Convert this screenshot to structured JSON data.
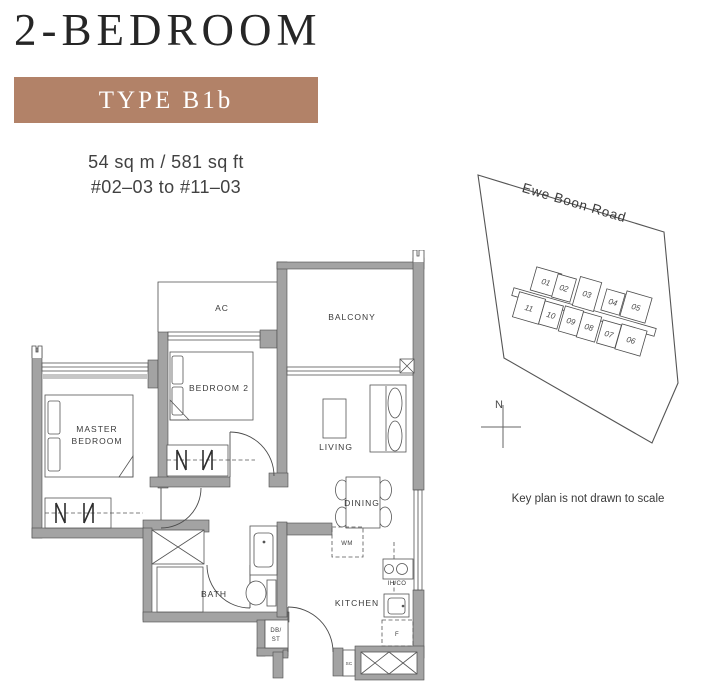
{
  "header": {
    "title": "2-BEDROOM",
    "type_label": "TYPE B1b",
    "area": "54 sq m / 581 sq ft",
    "unit_range": "#02–03 to #11–03"
  },
  "floor_plan": {
    "labels": {
      "ac": "AC",
      "balcony": "BALCONY",
      "bedroom2": "BEDROOM 2",
      "master_line1": "MASTER",
      "master_line2": "BEDROOM",
      "living": "LIVING",
      "dining": "DINING",
      "wm": "WM",
      "bath": "BATH",
      "kitchen": "KITCHEN",
      "ihco": "IH/CO",
      "fridge": "F",
      "dbst_line1": "DB/",
      "dbst_line2": "ST",
      "sc": "SC"
    }
  },
  "key_plan": {
    "road": "Ewe Boon Road",
    "note": "Key plan is not drawn to scale",
    "compass": "N",
    "highlighted_unit": "03",
    "units_top": [
      "01",
      "02",
      "03",
      "04",
      "05"
    ],
    "units_bottom": [
      "11",
      "10",
      "09",
      "08",
      "07",
      "06"
    ]
  },
  "colors": {
    "accent": "#b28268",
    "highlight_unit_fill": "#b0765a",
    "highlight_unit_text": "#6e4230",
    "wall_gray": "#a3a3a3",
    "line_dark": "#4c4c4c",
    "text_dark": "#3b3b3b"
  }
}
